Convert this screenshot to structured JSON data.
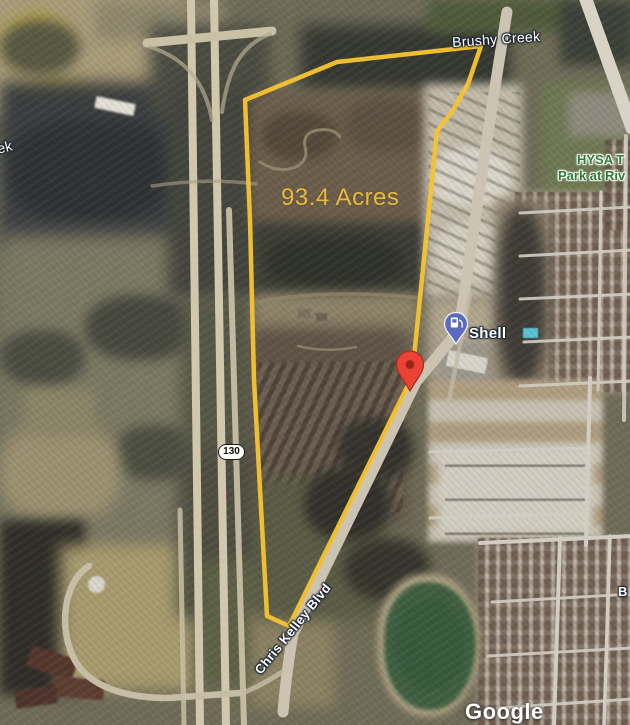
{
  "map": {
    "attribution": "Google",
    "parcel": {
      "area_label": "93.4 Acres",
      "outline_color": "#F5C332",
      "area_label_color": "#E9B93C"
    },
    "labels": {
      "brushy_creek": "Brushy Creek",
      "creek_partial": "ek",
      "park_line1": "HYSA T",
      "park_line2": "Park at Riv",
      "street_partial": "B",
      "chris_kelley_blvd": "Chris Kelley Blvd",
      "route_130": "130"
    },
    "poi": {
      "shell": {
        "name": "Shell",
        "pin_color": "#5B6ABF",
        "icon": "gas-pump"
      }
    },
    "marker": {
      "type": "location-pin",
      "color": "#EA4335"
    }
  }
}
